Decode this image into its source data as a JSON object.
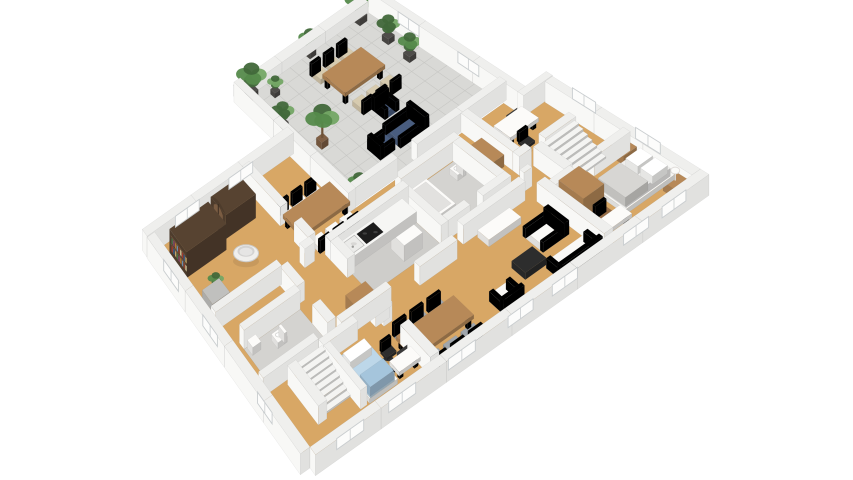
{
  "meta": {
    "view": "isometric-3d-floor-plan-render",
    "background": "#ffffff"
  },
  "palette": {
    "floor_wood": "#d8a765",
    "floor_tile": "#d9d9d6",
    "tile_line": "#c7c7c4",
    "floor_gray": "#cecdca",
    "floor_gray2": "#d4d3d0",
    "wall_top": "#efefed",
    "wall_a1": "#f8f8f6",
    "wall_b2": "#e1e1df",
    "wood_mid": "#b08455",
    "wood_dark": "#8f6843",
    "trunk": "#6e5136",
    "furn_dark_brown": "#54402f",
    "arch_inner": "#7a5c42",
    "counter_white": "#f2f1ef",
    "sofa_white": "#f0efed",
    "chair_beige": "#cfc3a8",
    "blue_dark": "#46597a",
    "blue_light": "#b6cfe0",
    "blue_fold": "#9fbdd4",
    "black": "#2b2b2b",
    "tv_screen": "#3a3a3a",
    "cooktop": "#1d1d1d",
    "gray_chair": "#9aa0a5",
    "green_dark": "#41683a",
    "green_mid": "#558a4b",
    "green_light": "#74a765",
    "pot_dark": "#4c4a47",
    "pot_brown": "#7b5b41",
    "lamp_white": "#fbfbf9",
    "stair_white": "#ebebe9",
    "glass_white": "#fcfcfb",
    "frame_gray": "#c9cdcf",
    "mattress_gray": "#e6e5e3",
    "blanket_gray": "#cfcecb",
    "pillow_white": "#f7f7f5",
    "steel": "#b9b9b7"
  },
  "book_colors": [
    "#a23b2e",
    "#3e5f8a",
    "#c2a368",
    "#49724a",
    "#8a4a6b",
    "#b5762f",
    "#6b8fae",
    "#94442f",
    "#d0c39a"
  ],
  "scene": {
    "rooms": [
      {
        "id": "terrace",
        "name": "terrace",
        "floor": "floor_tile"
      },
      {
        "id": "interior",
        "name": "main-floor",
        "floor": "floor_wood"
      },
      {
        "id": "kitchen",
        "name": "kitchen",
        "floor": "floor_gray"
      },
      {
        "id": "bathroom",
        "name": "bathroom",
        "floor": "floor_gray2"
      },
      {
        "id": "wc",
        "name": "wc",
        "floor": "floor_gray2"
      },
      {
        "id": "library",
        "name": "library",
        "floor": "floor_wood"
      },
      {
        "id": "dining",
        "name": "dining-room",
        "floor": "floor_wood"
      },
      {
        "id": "office",
        "name": "office",
        "floor": "floor_wood"
      },
      {
        "id": "bedroom",
        "name": "master-bedroom",
        "floor": "floor_wood"
      },
      {
        "id": "living",
        "name": "living-room",
        "floor": "floor_wood"
      },
      {
        "id": "bedroom2",
        "name": "bedroom-2",
        "floor": "floor_wood"
      },
      {
        "id": "hallway",
        "name": "hallway",
        "floor": "floor_wood"
      }
    ],
    "furniture": [
      {
        "id": "t_table",
        "name": "outdoor-dining-table",
        "room": "terrace",
        "color": "wood_mid"
      },
      {
        "id": "t_ch1",
        "name": "outdoor-chair-1",
        "room": "terrace",
        "color": "chair_beige"
      },
      {
        "id": "t_ch2",
        "name": "outdoor-chair-2",
        "room": "terrace",
        "color": "chair_beige"
      },
      {
        "id": "t_ch3",
        "name": "outdoor-chair-3",
        "room": "terrace",
        "color": "chair_beige"
      },
      {
        "id": "t_ch4",
        "name": "outdoor-chair-4",
        "room": "terrace",
        "color": "chair_beige"
      },
      {
        "id": "t_ch5",
        "name": "outdoor-chair-5",
        "room": "terrace",
        "color": "chair_beige"
      },
      {
        "id": "t_ch6",
        "name": "outdoor-chair-6",
        "room": "terrace",
        "color": "chair_beige"
      },
      {
        "id": "t_sofa",
        "name": "outdoor-sofa",
        "room": "terrace",
        "color": "blue_dark"
      },
      {
        "id": "t_arm1",
        "name": "outdoor-armchair-1",
        "room": "terrace",
        "color": "blue_dark"
      },
      {
        "id": "t_arm2",
        "name": "outdoor-armchair-2",
        "room": "terrace",
        "color": "blue_dark"
      },
      {
        "id": "tp1",
        "name": "terrace-plant-1",
        "room": "terrace",
        "color": "green_mid"
      },
      {
        "id": "tp2",
        "name": "terrace-plant-2",
        "room": "terrace",
        "color": "green_dark"
      },
      {
        "id": "tp3",
        "name": "terrace-plant-3",
        "room": "terrace",
        "color": "green_mid"
      },
      {
        "id": "tp4",
        "name": "terrace-plant-4",
        "room": "terrace",
        "color": "green_mid"
      },
      {
        "id": "tp5",
        "name": "terrace-plant-5",
        "room": "terrace",
        "color": "green_light"
      },
      {
        "id": "tp6",
        "name": "terrace-plant-6",
        "room": "terrace",
        "color": "green_mid"
      },
      {
        "id": "tp7",
        "name": "terrace-plant-7",
        "room": "terrace",
        "color": "green_dark"
      },
      {
        "id": "t_tree",
        "name": "terrace-tree",
        "room": "terrace",
        "color": "green_mid"
      },
      {
        "id": "bookshelf",
        "name": "bookshelf",
        "room": "library",
        "color": "furn_dark_brown"
      },
      {
        "id": "arch_cab",
        "name": "arched-cabinet",
        "room": "library",
        "color": "furn_dark_brown"
      },
      {
        "id": "round_chair",
        "name": "round-lounge-chair",
        "room": "library",
        "color": "sofa_white"
      },
      {
        "id": "side_tbl",
        "name": "side-table",
        "room": "library",
        "color": "steel"
      },
      {
        "id": "side_plant",
        "name": "side-table-plant",
        "room": "library",
        "color": "green_mid"
      },
      {
        "id": "d_table",
        "name": "dining-table",
        "room": "dining",
        "color": "wood_mid"
      },
      {
        "id": "d_ch1",
        "name": "dining-chair-1",
        "room": "dining",
        "color": "sofa_white"
      },
      {
        "id": "d_ch2",
        "name": "dining-chair-2",
        "room": "dining",
        "color": "sofa_white"
      },
      {
        "id": "d_ch3",
        "name": "dining-chair-3",
        "room": "dining",
        "color": "sofa_white"
      },
      {
        "id": "d_ch4",
        "name": "dining-chair-4",
        "room": "dining",
        "color": "sofa_white"
      },
      {
        "id": "d_ch5",
        "name": "dining-chair-5",
        "room": "dining",
        "color": "sofa_white"
      },
      {
        "id": "d_ch6",
        "name": "dining-chair-6",
        "room": "dining",
        "color": "sofa_white"
      },
      {
        "id": "d_plant",
        "name": "dining-room-plant",
        "room": "dining",
        "color": "green_mid"
      },
      {
        "id": "k_counter",
        "name": "kitchen-counter",
        "room": "kitchen",
        "color": "counter_white"
      },
      {
        "id": "k_shelf",
        "name": "kitchen-cabinet",
        "room": "kitchen",
        "color": "counter_white"
      },
      {
        "id": "k_brown",
        "name": "kitchen-sideboard",
        "room": "kitchen",
        "color": "wood_mid"
      },
      {
        "id": "tub",
        "name": "bathtub",
        "room": "bathroom",
        "color": "counter_white"
      },
      {
        "id": "toilet",
        "name": "toilet",
        "room": "bathroom",
        "color": "counter_white"
      },
      {
        "id": "wc_toilet",
        "name": "wc-toilet",
        "room": "wc",
        "color": "counter_white"
      },
      {
        "id": "wc_sink",
        "name": "wc-sink",
        "room": "wc",
        "color": "counter_white"
      },
      {
        "id": "o_desk",
        "name": "office-desk",
        "room": "office",
        "color": "counter_white"
      },
      {
        "id": "o_laptop",
        "name": "office-laptop",
        "room": "office",
        "color": "black"
      },
      {
        "id": "o_chair",
        "name": "office-chair",
        "room": "office",
        "color": "black"
      },
      {
        "id": "o_side",
        "name": "office-sideboard",
        "room": "office",
        "color": "wood_mid"
      },
      {
        "id": "st_up",
        "name": "staircase-upper",
        "room": "hallway",
        "color": "stair_white"
      },
      {
        "id": "st_low",
        "name": "staircase-lower",
        "room": "hallway",
        "color": "stair_white"
      },
      {
        "id": "bed",
        "name": "double-bed",
        "room": "bedroom",
        "color": "counter_white"
      },
      {
        "id": "ns1",
        "name": "nightstand-1",
        "room": "bedroom",
        "color": "wood_mid"
      },
      {
        "id": "lamp1",
        "name": "table-lamp-1",
        "room": "bedroom",
        "color": "lamp_white"
      },
      {
        "id": "ns2",
        "name": "nightstand-2",
        "room": "bedroom",
        "color": "wood_mid"
      },
      {
        "id": "lamp2",
        "name": "table-lamp-2",
        "room": "bedroom",
        "color": "lamp_white"
      },
      {
        "id": "wardrobe",
        "name": "wardrobe",
        "room": "bedroom",
        "color": "wood_mid"
      },
      {
        "id": "bd_desk",
        "name": "bedroom-desk",
        "room": "bedroom",
        "color": "counter_white"
      },
      {
        "id": "bd_chair",
        "name": "bedroom-chair",
        "room": "bedroom",
        "color": "wood_dark"
      },
      {
        "id": "tv_stand",
        "name": "tv-stand",
        "room": "living",
        "color": "counter_white"
      },
      {
        "id": "tv",
        "name": "tv",
        "room": "living",
        "color": "black"
      },
      {
        "id": "loveseat",
        "name": "loveseat",
        "room": "living",
        "color": "sofa_white"
      },
      {
        "id": "coffee",
        "name": "coffee-table",
        "room": "living",
        "color": "black"
      },
      {
        "id": "armchair",
        "name": "armchair",
        "room": "living",
        "color": "sofa_white"
      },
      {
        "id": "sofa2",
        "name": "sofa",
        "room": "living",
        "color": "sofa_white"
      },
      {
        "id": "g_table",
        "name": "living-dining-table",
        "room": "living",
        "color": "wood_mid"
      },
      {
        "id": "fruit",
        "name": "fruit-bowl",
        "room": "living",
        "color": "pot_brown"
      },
      {
        "id": "g_ch1",
        "name": "living-chair-1",
        "room": "living",
        "color": "gray_chair"
      },
      {
        "id": "g_ch2",
        "name": "living-chair-2",
        "room": "living",
        "color": "gray_chair"
      },
      {
        "id": "g_ch3",
        "name": "living-chair-3",
        "room": "living",
        "color": "gray_chair"
      },
      {
        "id": "g_ch4",
        "name": "living-chair-4",
        "room": "living",
        "color": "gray_chair"
      },
      {
        "id": "g_ch5",
        "name": "living-chair-5",
        "room": "living",
        "color": "gray_chair"
      },
      {
        "id": "g_ch6",
        "name": "living-chair-6",
        "room": "living",
        "color": "gray_chair"
      },
      {
        "id": "s_bed",
        "name": "single-bed-blue",
        "room": "bedroom2",
        "color": "blue_light"
      },
      {
        "id": "s_desk",
        "name": "bedroom2-desk",
        "room": "bedroom2",
        "color": "counter_white"
      },
      {
        "id": "s_laptop",
        "name": "bedroom2-laptop",
        "room": "bedroom2",
        "color": "black"
      },
      {
        "id": "s_chair",
        "name": "bedroom2-desk-chair",
        "room": "bedroom2",
        "color": "black"
      },
      {
        "id": "s_plant",
        "name": "floor-plant",
        "room": "living",
        "color": "green_mid"
      }
    ],
    "windows": {
      "southeast_facade": 7,
      "east_facade": 2,
      "west_facade": 3,
      "north_wing_facade": 2,
      "northeast_facade": 2
    }
  }
}
